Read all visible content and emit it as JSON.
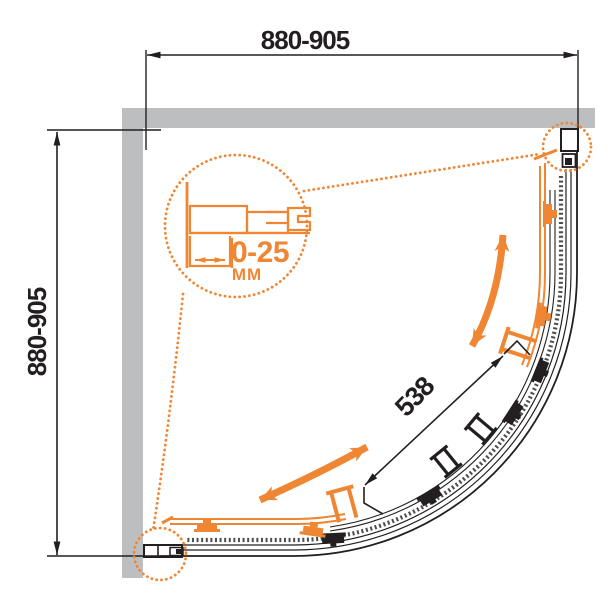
{
  "diagram": {
    "subject": "quarter-round corner shower enclosure",
    "view": "top view technical drawing"
  },
  "dimensions": {
    "top_width": "880-905",
    "left_depth": "880-905",
    "door_opening": "538",
    "profile_adjustment": "0-25",
    "profile_adjustment_unit": "MM"
  },
  "colors": {
    "accent_orange": "#EF8633",
    "wall_gray": "#BCBEC0",
    "line_black": "#231F20",
    "background": "#FFFFFF"
  },
  "icons": {
    "slide_direction": "curved-double-headed-arrow",
    "detail_callout": "dotted-magnifier-circle"
  }
}
